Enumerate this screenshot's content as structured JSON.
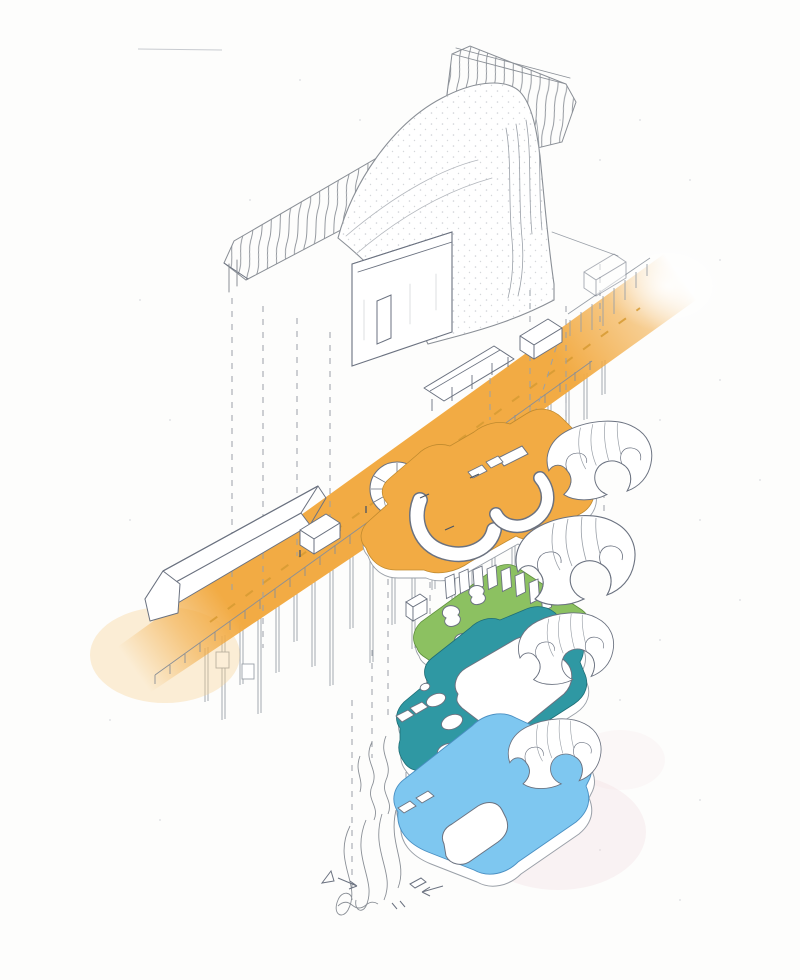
{
  "figure": {
    "type": "exploded-axonometric-architecture-sketch",
    "colors": {
      "paper": "#fdfdfc",
      "ink": "#6b7280",
      "faint": "#a3a8af",
      "street": "#F2AB44",
      "street_glow": "#F7CE8C",
      "green": "#8CC161",
      "teal": "#2F98A3",
      "blue": "#7EC7F0",
      "pink": "#F2D9DE",
      "centerline": "#D69A33"
    },
    "elements": [
      {
        "id": "existing-building",
        "fill": "#ffffff"
      },
      {
        "id": "street-deck",
        "fill": "street"
      },
      {
        "id": "level-plate-1",
        "fill": "street"
      },
      {
        "id": "level-plate-2",
        "fill": "green"
      },
      {
        "id": "level-plate-3",
        "fill": "teal"
      },
      {
        "id": "level-plate-4",
        "fill": "blue"
      }
    ]
  }
}
